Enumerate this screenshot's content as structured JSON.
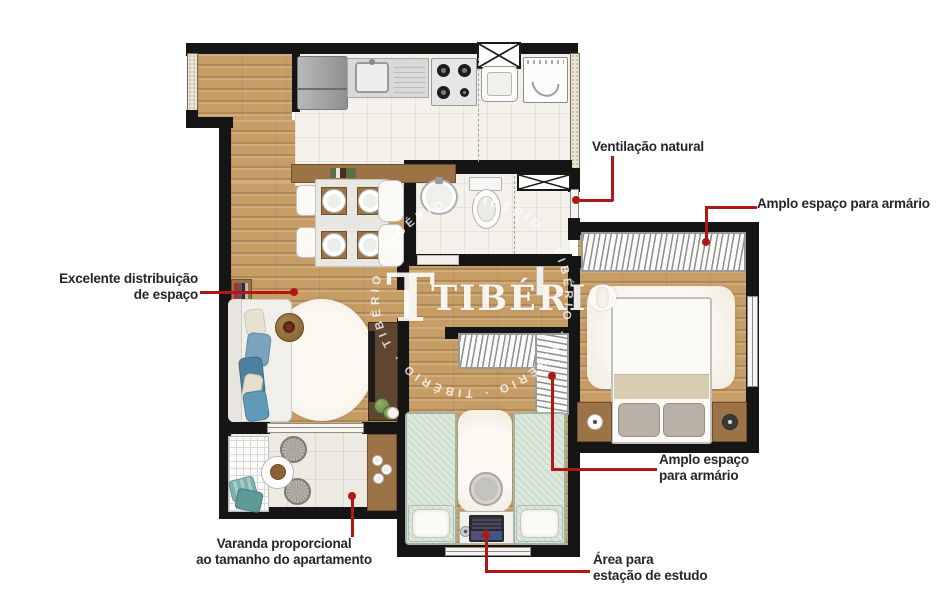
{
  "watermark": {
    "monogram": "T",
    "brand": "TIBÉRIO",
    "ring_text": "TIBÉRIO · TIBÉRIO · TIBÉRIO · TIBÉRIO · TIBÉRIO · TIBÉRIO"
  },
  "annotations": {
    "ventilation": {
      "text": "Ventilação natural"
    },
    "wardrobe_master": {
      "text": "Amplo espaço para armário"
    },
    "distribution": {
      "line1": "Excelente distribuição",
      "line2": "de espaço"
    },
    "wardrobe_second": {
      "line1": "Amplo espaço",
      "line2": "para armário"
    },
    "balcony": {
      "line1": "Varanda proporcional",
      "line2": "ao tamanho do apartamento"
    },
    "study": {
      "line1": "Área para",
      "line2": "estação de estudo"
    }
  },
  "colors": {
    "leader_red": "#b01815",
    "wall_black": "#151515",
    "wood_floor": "#c79d66",
    "tile_floor": "#f3f1e9",
    "balcony_tile": "#edebe1",
    "mint_bed": "#cfe0d0",
    "blue_pillow": "#6f96ae",
    "wood_furniture": "#9c7347",
    "watermark_white": "#ffffff"
  }
}
